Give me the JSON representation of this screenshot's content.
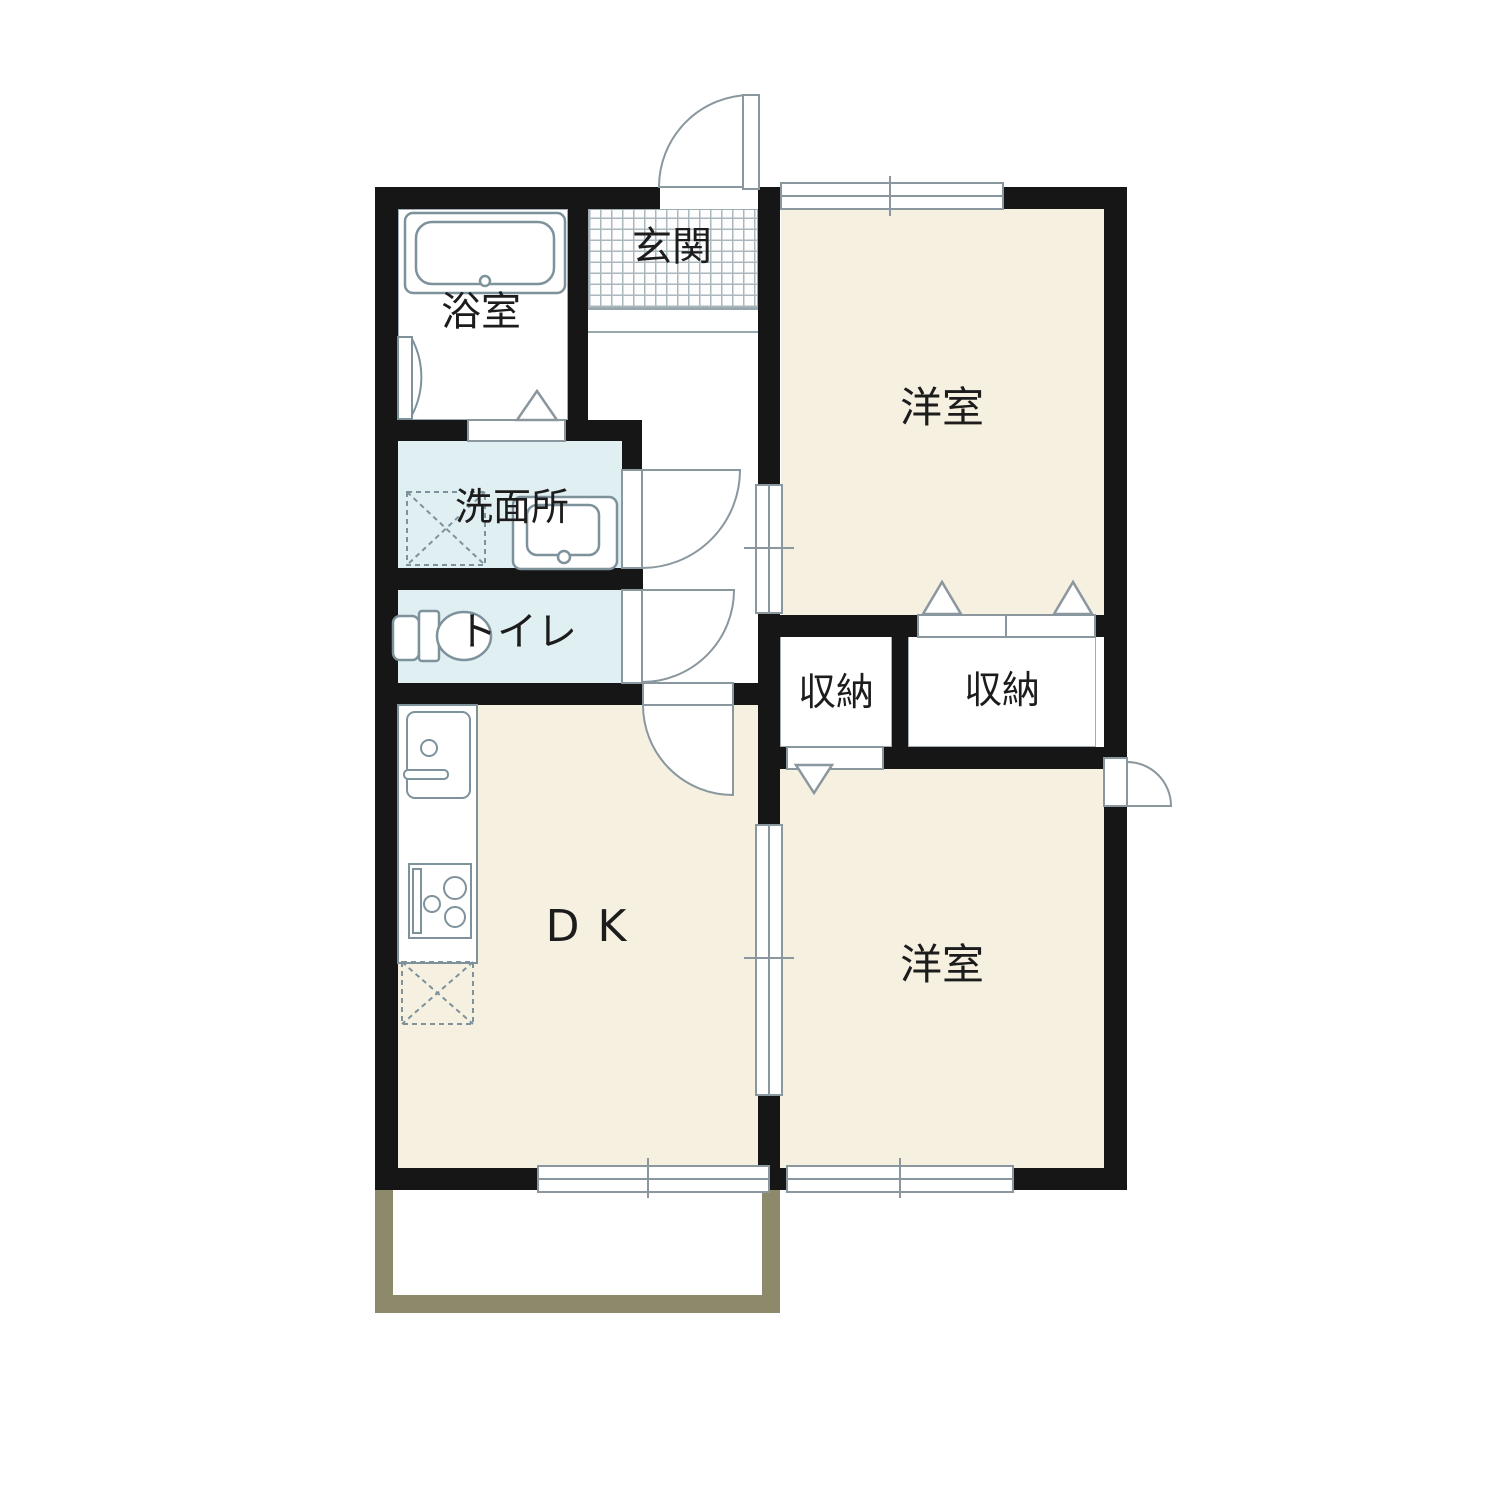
{
  "plan_type": "floorplan",
  "rooms": {
    "genkan": {
      "label": "玄関"
    },
    "bathroom": {
      "label": "浴室"
    },
    "washroom": {
      "label": "洗面所"
    },
    "toilet": {
      "label": "トイレ"
    },
    "dining_kitchen": {
      "label": "DK"
    },
    "western_room_upper": {
      "label": "洋室"
    },
    "western_room_lower": {
      "label": "洋室"
    },
    "closet_small": {
      "label": "収納"
    },
    "closet_large": {
      "label": "収納"
    }
  },
  "colors": {
    "wall": "#161616",
    "floor_beige": "#f6f0e1",
    "floor_blue": "#e0eff2",
    "fixture_line": "#7e929c",
    "band_line": "#8a979e",
    "tile_line": "#aab7bd",
    "balcony_border": "#8c8a6b",
    "text": "#1c1c1c"
  }
}
